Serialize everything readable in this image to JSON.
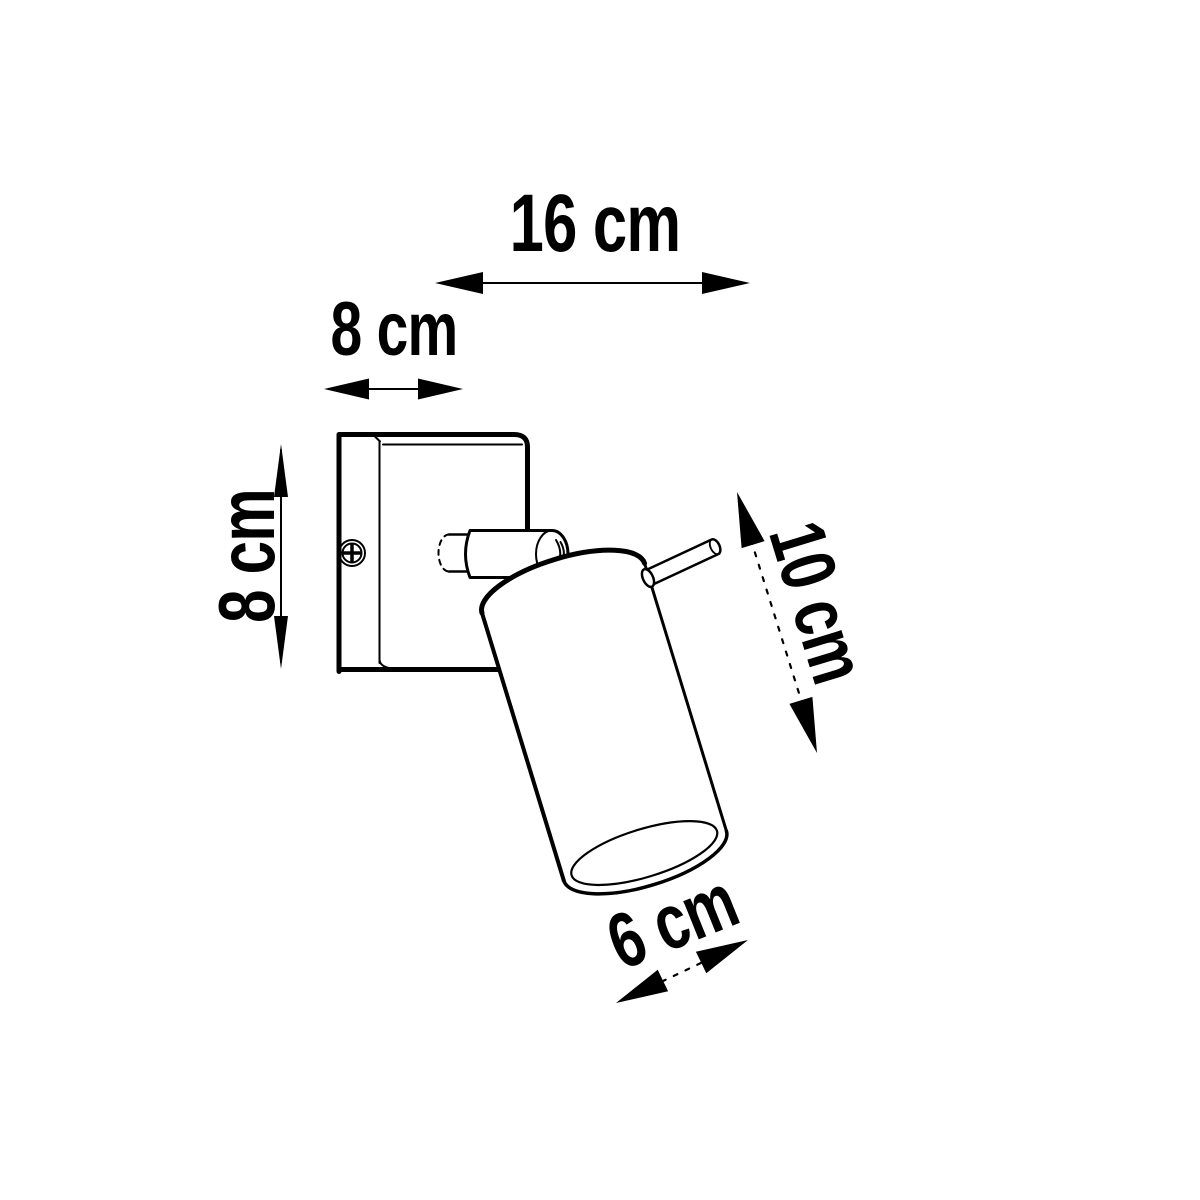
{
  "page": {
    "background_color": "#ffffff",
    "line_color": "#000000"
  },
  "diagram": {
    "subject": "wall-mounted adjustable spotlight, dimensional line drawing",
    "labels": {
      "total_width": "16 cm",
      "plate_width": "8 cm",
      "plate_height": "8 cm",
      "shade_length": "10 cm",
      "shade_diameter": "6 cm"
    }
  }
}
